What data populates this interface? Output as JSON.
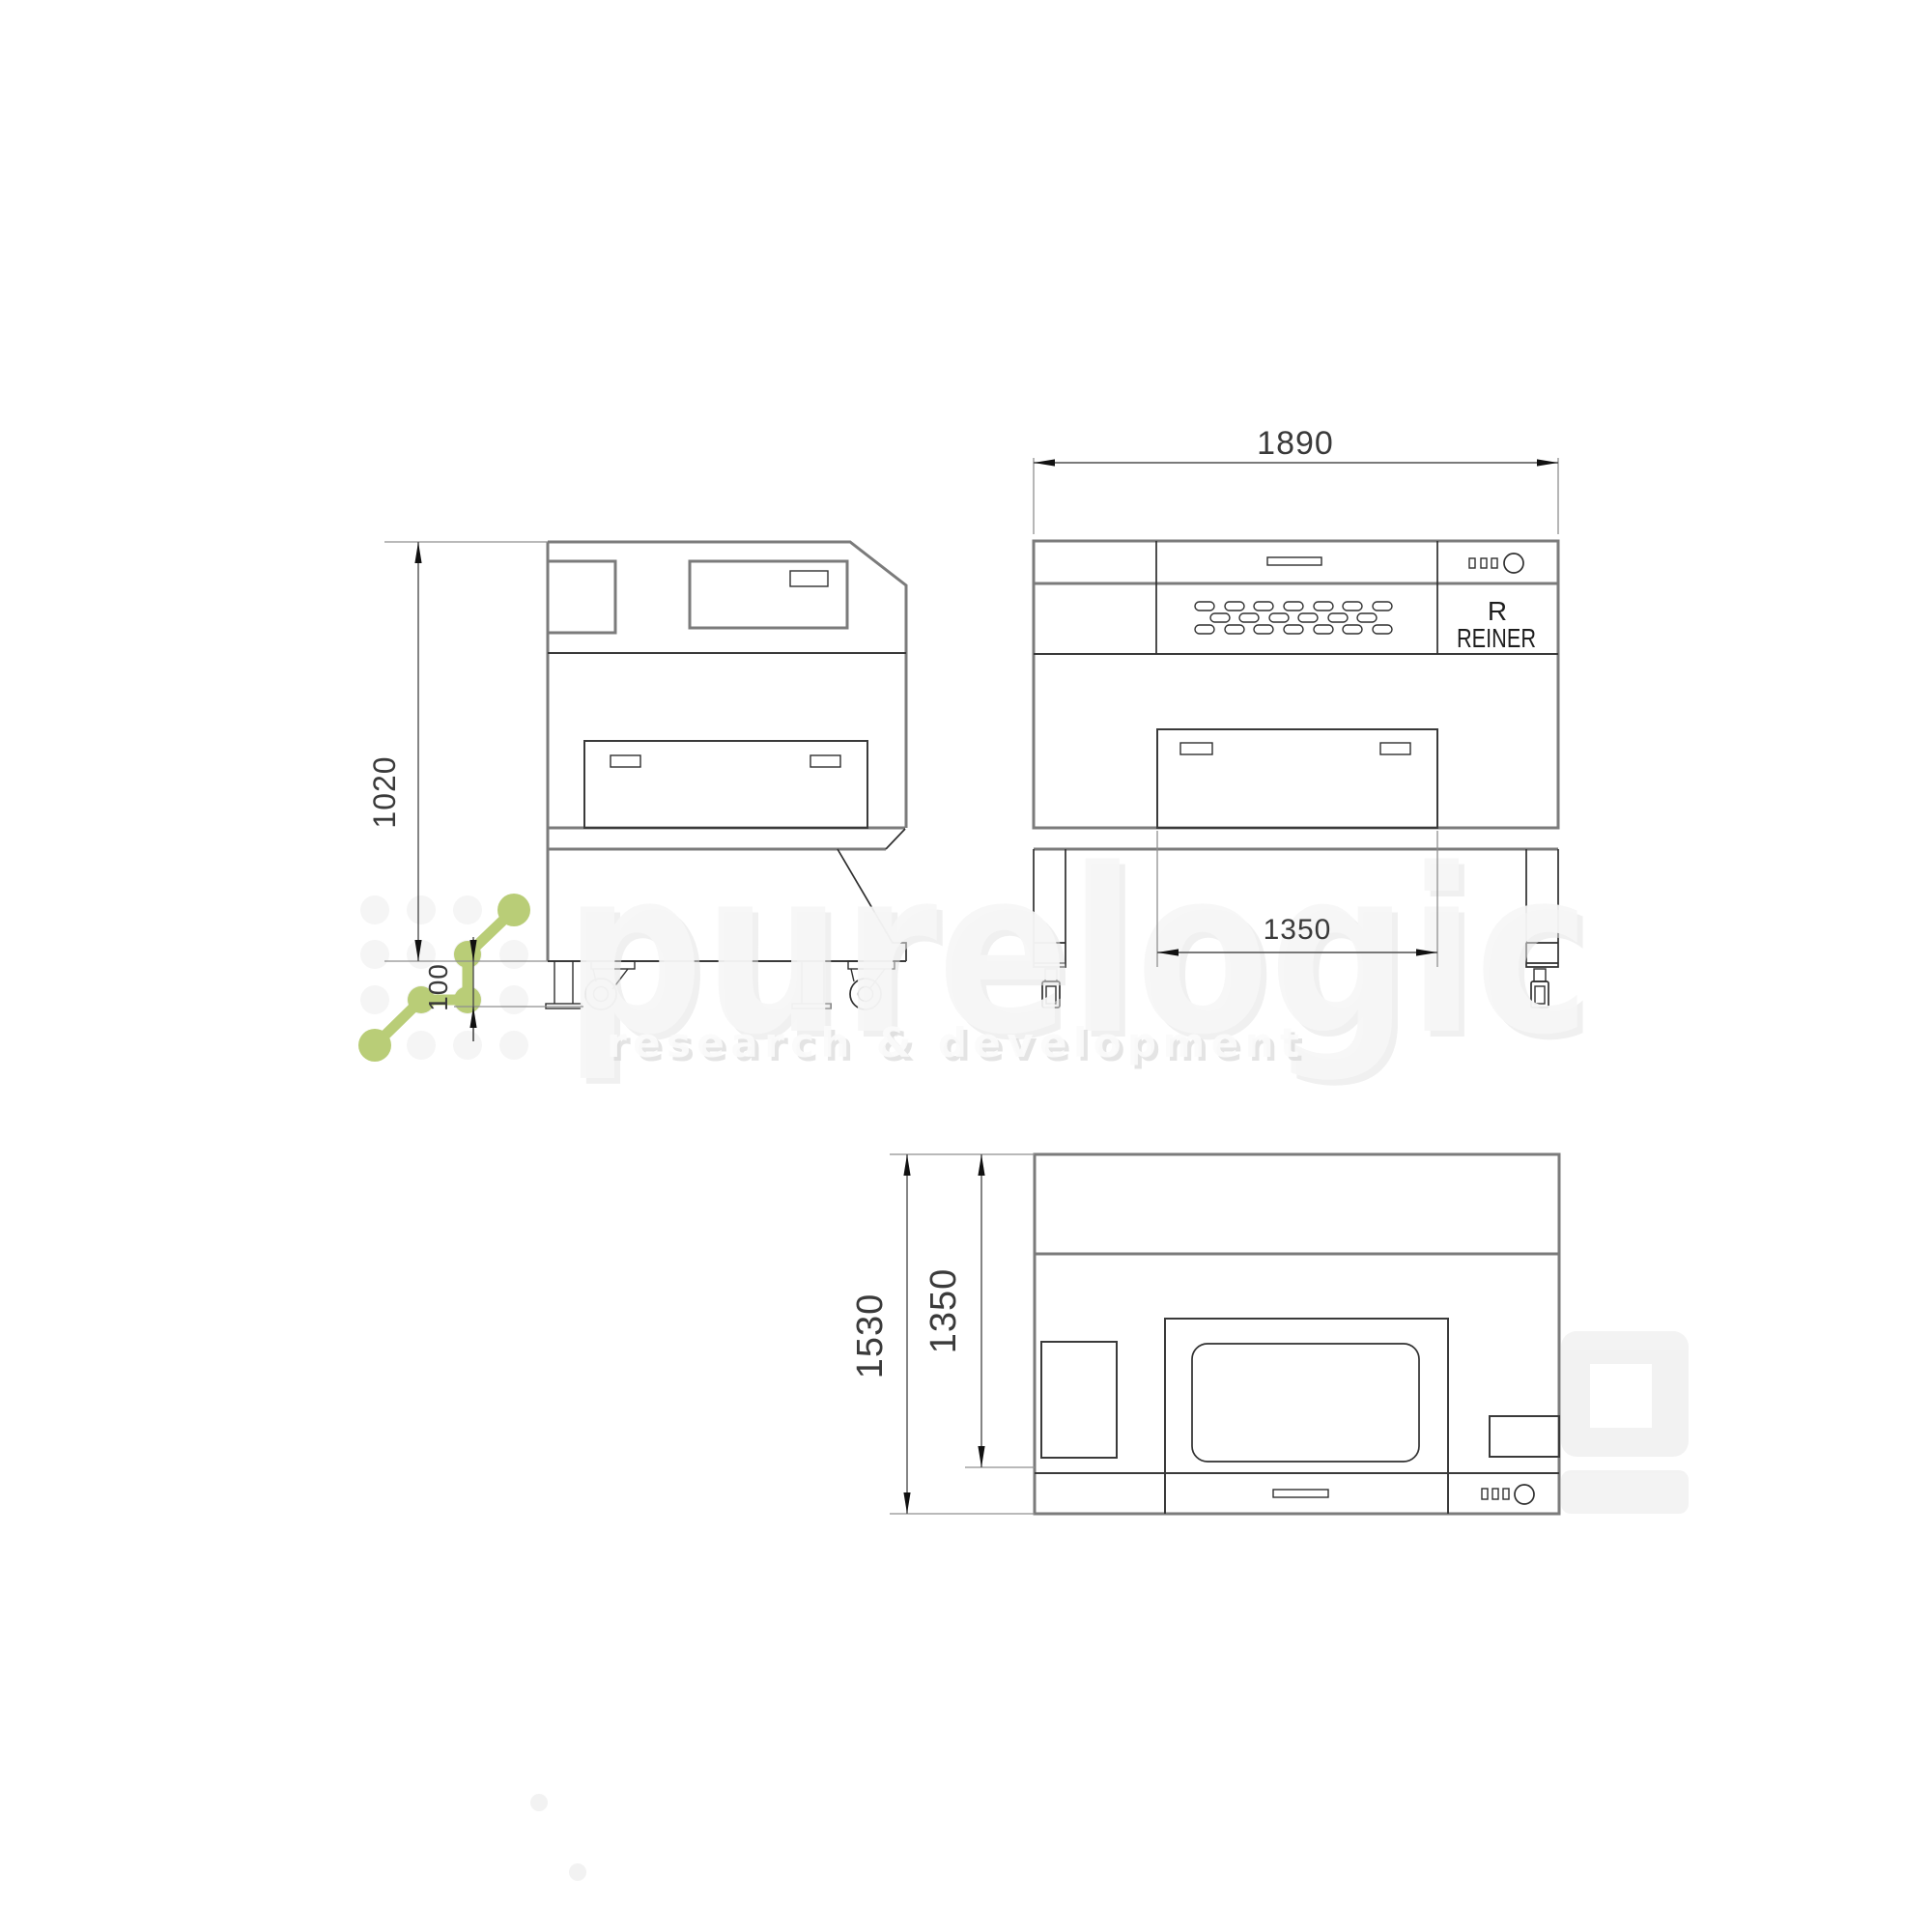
{
  "drawing": {
    "views": {
      "side": {
        "height_mm": "1020",
        "caster_mm": "100"
      },
      "front": {
        "width_mm": "1890",
        "inner_width_mm": "1350"
      },
      "top": {
        "depth_total_mm": "1530",
        "depth_body_mm": "1350"
      }
    },
    "brand": {
      "initial": "R",
      "name": "REINER"
    }
  },
  "watermark": {
    "word": "purelogic",
    "tagline": "research & development"
  },
  "colors": {
    "green": "#b6cb70",
    "line_heavy": "#7b7b7b",
    "line_dark": "#2f2f2f",
    "dim_line": "#4f4f4f"
  }
}
